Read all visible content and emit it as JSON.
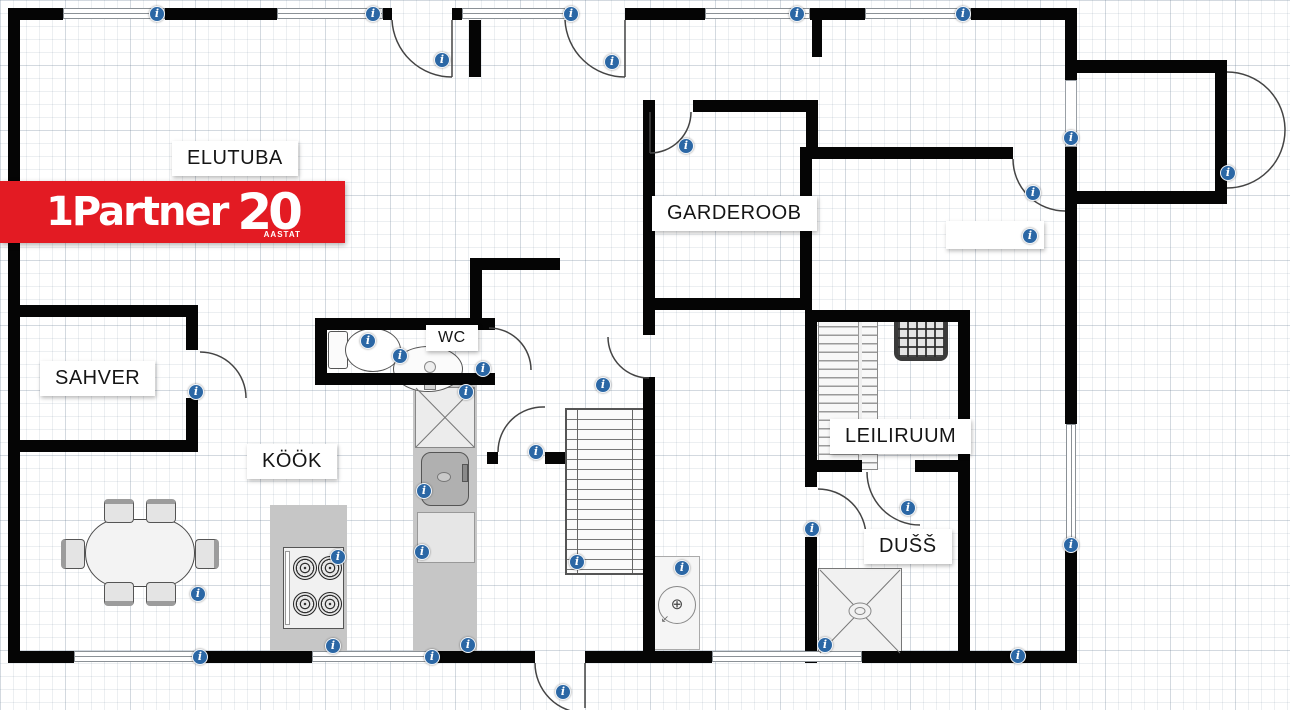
{
  "logo": {
    "brand": "1Partner",
    "anniversary_number": "20",
    "anniversary_text": "AASTAT"
  },
  "rooms": {
    "living_room": "ELUTUBA",
    "wardrobe": "GARDEROOB",
    "pantry": "SAHVER",
    "toilet": "WC",
    "kitchen": "KÖÖK",
    "sauna": "LEILIRUUM",
    "shower": "DUŠŠ"
  },
  "icons": {
    "info_glyph": "i",
    "drain_glyph": "⊕",
    "arrow_glyph": "↙"
  },
  "colors": {
    "brand_red": "#e31b23",
    "info_blue": "#2b67a5",
    "wall_black": "#050505"
  }
}
